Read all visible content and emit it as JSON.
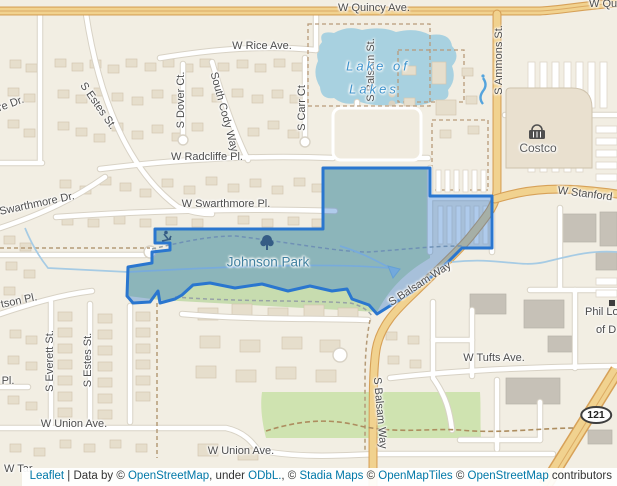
{
  "map": {
    "street_labels": {
      "w_quincy_ave": "W Quincy Ave.",
      "w_rice_ave": "W Rice Ave.",
      "s_estes_st": "S Estes St.",
      "s_dover_ct": "S Dover Ct.",
      "south_cody_way": "South Cody Way",
      "s_carr_ct": "S Carr Ct",
      "s_balsam_st": "S Balsam St.",
      "s_ammons_st": "S Ammons St.",
      "re_dr": "re Dr.",
      "w_radcliffe_pl": "W Radcliffe Pl.",
      "swarthmore_dr": "Swarthmore Dr.",
      "w_swarthmore_pl": "W Swarthmore Pl.",
      "w_stanford": "W Stanford",
      "s_balsam_way": "S Balsam Way",
      "w_tufts_ave": "W Tufts Ave.",
      "tson_pl": "tson Pl.",
      "pl": "Pl.",
      "s_everett_st": "S Everett St.",
      "w_union_ave": "W Union Ave.",
      "w_tar": "W Tar"
    },
    "poi_labels": {
      "lake_line1": "Lake of",
      "lake_line2": "Lakes",
      "johnson_park": "Johnson Park",
      "costco": "Costco",
      "phil_line1": "Phil Lo",
      "phil_line2": "of D"
    },
    "shield": {
      "route_121": "121"
    },
    "colors": {
      "selection_stroke": "#2a76cf",
      "selection_fill": "rgba(45,118,205,0.38)",
      "water": "#a8d1e0",
      "major_road": "#f1d28f",
      "park_green": "#cfe3b0",
      "link_blue": "#0078a8"
    }
  },
  "attribution": {
    "leaflet": "Leaflet",
    "data_by": " | Data by © ",
    "osm1": "OpenStreetMap",
    "under": ", under ",
    "odbl": "ODbL.",
    "c1": ", © ",
    "stadia": "Stadia Maps",
    "c2": " © ",
    "openmaptiles": "OpenMapTiles",
    "c3": " © ",
    "osm2": "OpenStreetMap",
    "contributors": " contributors"
  }
}
